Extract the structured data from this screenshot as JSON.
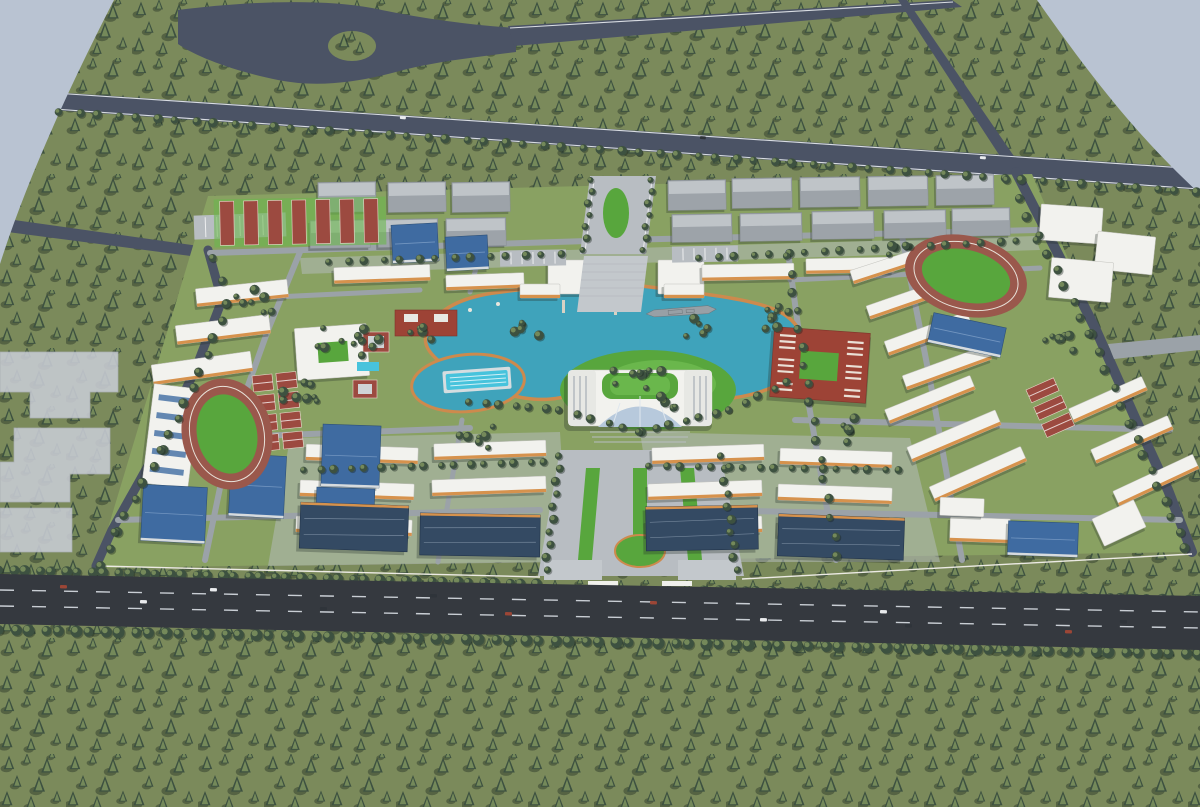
{
  "scene": {
    "description": "Aerial bird's-eye 3D architectural rendering of a large campus master plan with a central teal lake, surrounded by dense forest and perimeter highways",
    "view": "oblique aerial perspective",
    "canvas": {
      "width": 1200,
      "height": 807
    }
  },
  "palette": {
    "skyVoid": "#b9c3d2",
    "forestGround": "#7b8a5b",
    "treeDark": "#3d5140",
    "treeMid": "#56694b",
    "treeLight": "#74895a",
    "roadMajor": "#4b5365",
    "roadEdge": "#d9dde3",
    "highway": "#35393f",
    "laneMark": "#c9ced4",
    "campusGround": "#89a162",
    "campusRoad": "#9ba2a8",
    "pathLight": "#b8bdc2",
    "plaza": "#c3c8cc",
    "lake": "#3fa3bb",
    "shore": "#cd8a4d",
    "pool": "#47c3dc",
    "poolDeck": "#d5dde0",
    "track": "#9a584c",
    "field": "#58a63d",
    "fieldLight": "#6ab74c",
    "courtRed": "#9c4a40",
    "courtClay": "#a65a50",
    "bldgWhite": "#f2f2ee",
    "roofWhite": "#e7e8e4",
    "orangeTrim": "#d6924d",
    "grayRoof": "#9da3a9",
    "grayRoofLight": "#bfc4c8",
    "blueRoof": "#3f6ba1",
    "navyRoof": "#344a63",
    "redBldg": "#9d4336",
    "glass": "#b7c9dc",
    "ghost": "#c8ccd4",
    "ship": "#98a0a6",
    "carDark": "#2f343a"
  },
  "landmarks": [
    {
      "name": "central-lake"
    },
    {
      "name": "moored-warship"
    },
    {
      "name": "main-hall-with-green-roof-and-glass-atrium"
    },
    {
      "name": "round-pond-with-swimming-pool"
    },
    {
      "name": "west-running-track"
    },
    {
      "name": "east-running-track"
    },
    {
      "name": "tennis-court-grid"
    },
    {
      "name": "red-courtyard-buildings"
    },
    {
      "name": "north-service-warehouse-rows"
    },
    {
      "name": "north-gate-boulevard"
    },
    {
      "name": "south-main-gate-axis"
    },
    {
      "name": "white-dormitory-slabs-with-orange-trim"
    },
    {
      "name": "blue-roof-gymnasiums"
    },
    {
      "name": "navy-roof-halls"
    },
    {
      "name": "highway-interchange-roundabout"
    },
    {
      "name": "perimeter-highway"
    },
    {
      "name": "ghost-future-phase-buildings"
    },
    {
      "name": "surrounding-pine-forest"
    }
  ],
  "counts": {
    "running_tracks": 2,
    "stadium_fields": 2,
    "lakes": 2,
    "ships": 1
  }
}
